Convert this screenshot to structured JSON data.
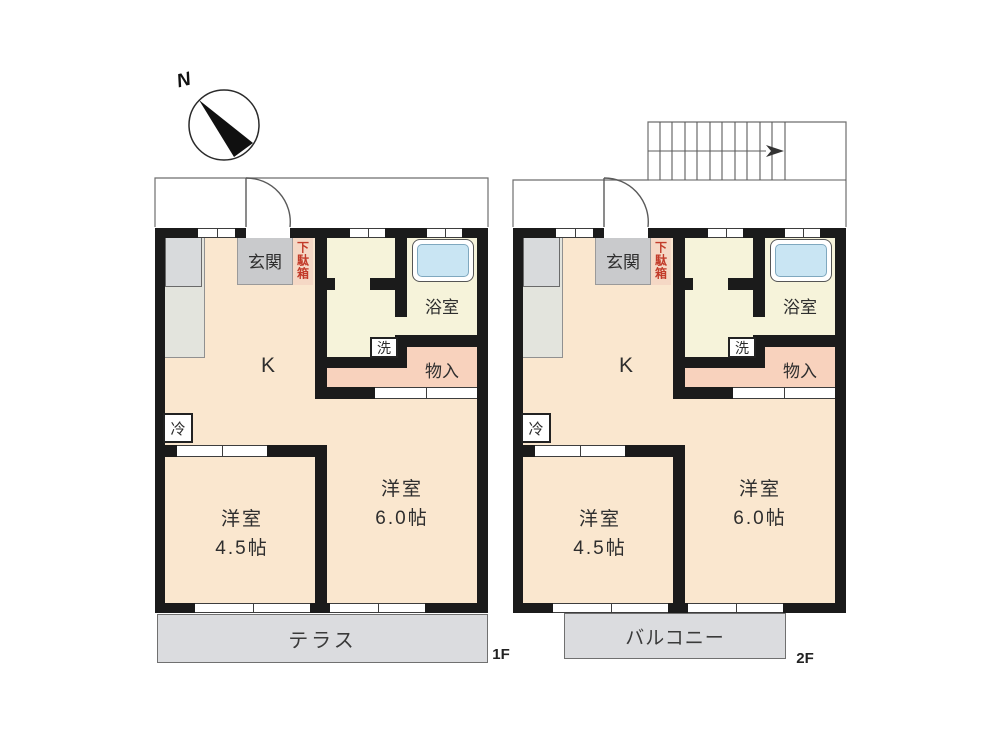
{
  "compass": {
    "north_label": "N"
  },
  "palette": {
    "wall": "#1b1b1b",
    "room_floor": "#fae7cf",
    "wet_area_floor": "#f6f3da",
    "storage_pink": "#f8d2bd",
    "entrance_gray": "#c9cacc",
    "shoe_cabinet_pink": "#f5d8c5",
    "bathtub_blue": "#c9e5f3",
    "outdoor_gray": "#dbdcdf",
    "shoe_cabinet_text_red": "#c23b2a"
  },
  "floor1": {
    "floor_label": "1F",
    "outdoor_label": "テラス",
    "kitchen_label": "K",
    "entrance_label": "玄関",
    "shoe_cabinet_label": "下駄箱",
    "bathroom_label": "浴室",
    "washstand_label": "洗",
    "storage_label": "物入",
    "fridge_label": "冷",
    "room_small": {
      "name": "洋室",
      "size": "4.5帖"
    },
    "room_large": {
      "name": "洋室",
      "size": "6.0帖"
    }
  },
  "floor2": {
    "floor_label": "2F",
    "outdoor_label": "バルコニー",
    "kitchen_label": "K",
    "entrance_label": "玄関",
    "shoe_cabinet_label": "下駄箱",
    "bathroom_label": "浴室",
    "washstand_label": "洗",
    "storage_label": "物入",
    "fridge_label": "冷",
    "room_small": {
      "name": "洋室",
      "size": "4.5帖"
    },
    "room_large": {
      "name": "洋室",
      "size": "6.0帖"
    }
  }
}
